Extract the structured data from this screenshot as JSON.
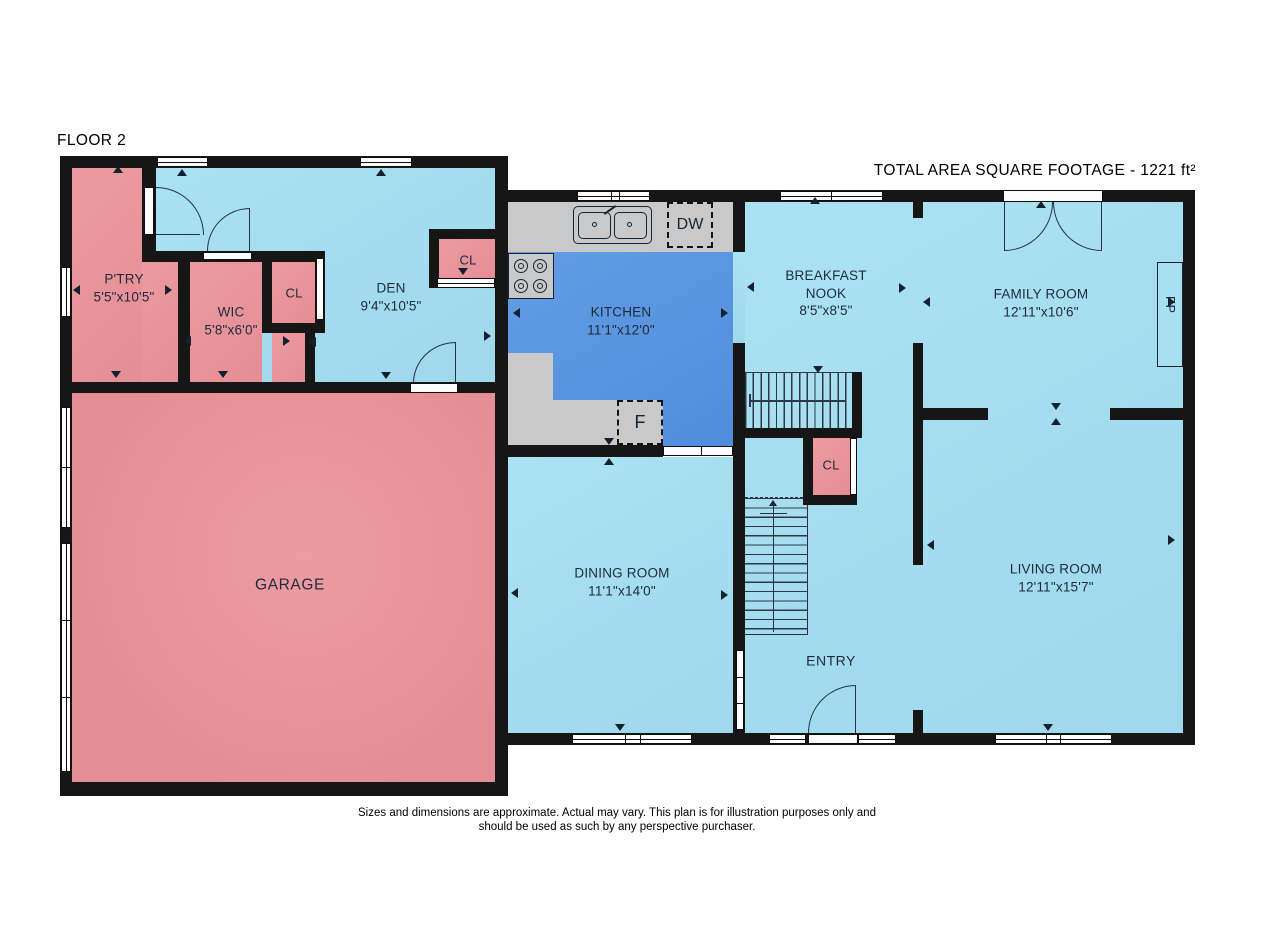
{
  "title": "FLOOR 2",
  "total_area_label": "TOTAL AREA SQUARE FOOTAGE - 1221 ft²",
  "rooms": {
    "pantry": {
      "name": "P'TRY",
      "dims": "5'5\"x10'5\""
    },
    "wic": {
      "name": "WIC",
      "dims": "5'8\"x6'0\""
    },
    "wic_closet": {
      "name": "CL"
    },
    "den": {
      "name": "DEN",
      "dims": "9'4\"x10'5\""
    },
    "den_closet": {
      "name": "CL"
    },
    "garage": {
      "name": "GARAGE"
    },
    "kitchen": {
      "name": "KITCHEN",
      "dims": "11'1\"x12'0\""
    },
    "dining_room": {
      "name": "DINING ROOM",
      "dims": "11'1\"x14'0\""
    },
    "breakfast_nook": {
      "name_line1": "BREAKFAST",
      "name_line2": "NOOK",
      "dims": "8'5\"x8'5\""
    },
    "family_room": {
      "name": "FAMILY ROOM",
      "dims": "12'11\"x10'6\""
    },
    "living_room": {
      "name": "LIVING ROOM",
      "dims": "12'11\"x15'7\""
    },
    "entry": {
      "name": "ENTRY"
    },
    "entry_closet": {
      "name": "CL"
    }
  },
  "appliances": {
    "dishwasher": "DW",
    "refrigerator": "F",
    "fireplace": "FP"
  },
  "disclaimer": {
    "line1": "Sizes and dimensions are approximate. Actual may vary. This plan is for illustration purposes only and",
    "line2": "should be used as such by any perspective purchaser."
  },
  "colors": {
    "room_pink": "#e9949b",
    "room_blue": "#a7e0f1",
    "kitchen_blue": "#5b95e0",
    "counter_gray": "#c9c9c9",
    "wall": "#161616"
  }
}
